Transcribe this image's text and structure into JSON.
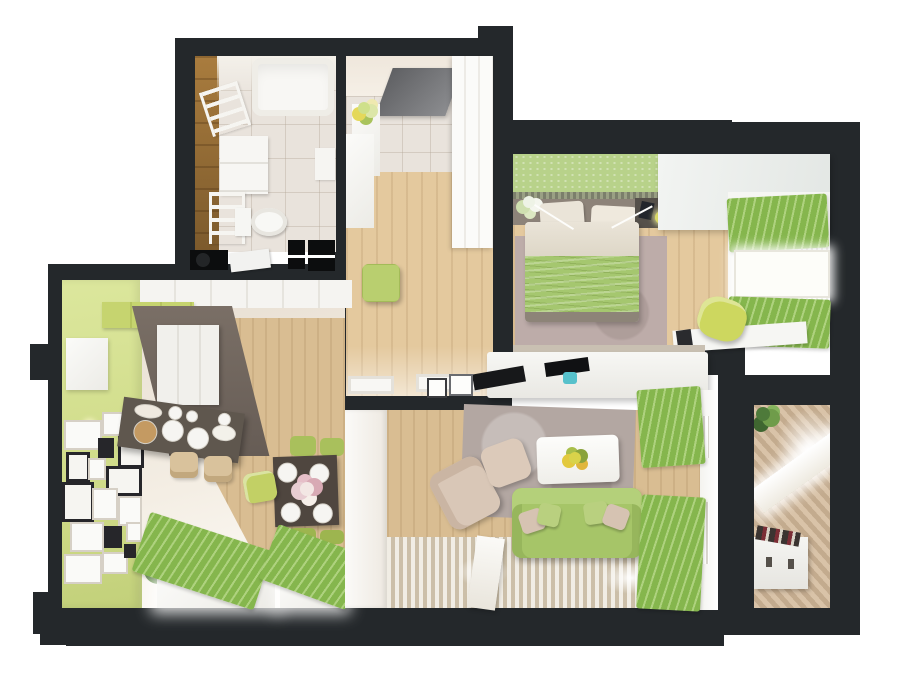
{
  "scene": {
    "type": "3d-floor-plan-render",
    "view": "top-down cutaway",
    "background": "#ffffff",
    "rooms": [
      {
        "id": "bathroom",
        "furniture": [
          "bathtub",
          "towel-ladder",
          "vanity",
          "toilet",
          "wall-cabinet",
          "wood-accent-wall"
        ]
      },
      {
        "id": "entry-hall",
        "furniture": [
          "entrance-door",
          "flower-pedestal",
          "console",
          "wardrobe",
          "green-pouf"
        ]
      },
      {
        "id": "bedroom",
        "furniture": [
          "green-headboard-wall",
          "double-bed",
          "nightstand",
          "lamp",
          "rug",
          "wardrobe",
          "window-curtains",
          "desk",
          "chair"
        ]
      },
      {
        "id": "living-kitchen",
        "furniture": [
          "green-accent-wall",
          "gallery-frames",
          "kitchen-cabinets",
          "island-counter",
          "bar-stools",
          "dining-table",
          "chairs",
          "plant",
          "window-drapes"
        ]
      },
      {
        "id": "living-room",
        "furniture": [
          "tv-console",
          "tv",
          "gray-rug",
          "coffee-table",
          "armchair",
          "ottoman",
          "green-sofa",
          "striped-rug",
          "window-curtains",
          "radiator"
        ]
      },
      {
        "id": "balcony",
        "furniture": [
          "plant",
          "window",
          "storage-bench",
          "slatted-floor"
        ]
      }
    ]
  },
  "palette": {
    "wall": "#24282b",
    "wallBlack": "#0c0d0e",
    "woodLight": "#e4c99e",
    "woodMid": "#d9bd92",
    "woodBath": "#8f6a35",
    "tile": "#e9e3dc",
    "cream": "#e9e0d4",
    "white": "#f5f4f1",
    "windowBright": "#fdfdf9",
    "greenWallPaint": "#dce79d",
    "greenCabinet": "#c6d46f",
    "greenCurtain": "#85b64d",
    "greenCurtainLight": "#aed27e",
    "greenBedWall": "#b8d28a",
    "blanket": "#a5c76f",
    "sofaGreen": "#a6c568",
    "pouf": "#b9cf6f",
    "chairGreen": "#cdd75f",
    "taupeFloor": "#6e635a",
    "islandDark": "#5f574e",
    "tableDark": "#4f463f",
    "rugGray": "#b3a7a2",
    "rugPink": "#bdaca9",
    "beige": "#d9c7b7",
    "stool": "#d9c29c",
    "balconyFloor": "#ccb49a",
    "doorGray": "#6a6b6e",
    "headboard": "#8d8379",
    "duvet": "#eae4d8",
    "teal": "#57c1cb",
    "lamp": "#e0e06a",
    "boardTan": "#c49a62",
    "plantGreen": "#6f9c4a",
    "plantDark": "#4e7a3a"
  },
  "gallery_frames": [
    {
      "x": 2,
      "y": 140,
      "w": 34,
      "h": 26,
      "kind": "w"
    },
    {
      "x": 40,
      "y": 132,
      "w": 26,
      "h": 20,
      "kind": "w"
    },
    {
      "x": 56,
      "y": 156,
      "w": 20,
      "h": 26,
      "kind": "b"
    },
    {
      "x": 36,
      "y": 158,
      "w": 16,
      "h": 20,
      "kind": "d"
    },
    {
      "x": 4,
      "y": 172,
      "w": 18,
      "h": 24,
      "kind": "b"
    },
    {
      "x": 26,
      "y": 178,
      "w": 14,
      "h": 18,
      "kind": "w"
    },
    {
      "x": 44,
      "y": 186,
      "w": 30,
      "h": 24,
      "kind": "b"
    },
    {
      "x": 0,
      "y": 202,
      "w": 26,
      "h": 34,
      "kind": "b"
    },
    {
      "x": 30,
      "y": 208,
      "w": 22,
      "h": 28,
      "kind": "w"
    },
    {
      "x": 56,
      "y": 216,
      "w": 20,
      "h": 26,
      "kind": "w"
    },
    {
      "x": 8,
      "y": 242,
      "w": 30,
      "h": 26,
      "kind": "w"
    },
    {
      "x": 42,
      "y": 246,
      "w": 18,
      "h": 22,
      "kind": "d"
    },
    {
      "x": 64,
      "y": 242,
      "w": 12,
      "h": 16,
      "kind": "w"
    },
    {
      "x": 2,
      "y": 274,
      "w": 34,
      "h": 26,
      "kind": "w"
    },
    {
      "x": 40,
      "y": 272,
      "w": 22,
      "h": 18,
      "kind": "w"
    },
    {
      "x": 62,
      "y": 264,
      "w": 12,
      "h": 14,
      "kind": "d"
    }
  ],
  "island_items": [
    {
      "name": "cutting-board",
      "x": 14,
      "y": 20,
      "d": 22,
      "color": "#c49a62"
    },
    {
      "name": "plate",
      "x": 42,
      "y": 16,
      "d": 20
    },
    {
      "name": "plate",
      "x": 68,
      "y": 20,
      "d": 20
    },
    {
      "name": "bowl",
      "x": 46,
      "y": 2,
      "d": 12
    },
    {
      "name": "bowl",
      "x": 64,
      "y": 4,
      "d": 10
    },
    {
      "name": "tray",
      "x": 12,
      "y": 4,
      "w": 26,
      "h": 12,
      "color": "#efe9df"
    },
    {
      "name": "tray",
      "x": 92,
      "y": 14,
      "w": 22,
      "h": 14,
      "color": "#f3f1ea"
    },
    {
      "name": "bowl",
      "x": 96,
      "y": 2,
      "d": 11
    }
  ],
  "dining_plates": [
    {
      "name": "plate",
      "x": 4,
      "y": 6,
      "d": 18
    },
    {
      "name": "plate",
      "x": 36,
      "y": 8,
      "d": 18
    },
    {
      "name": "plate",
      "x": 6,
      "y": 46,
      "d": 18
    },
    {
      "name": "plate",
      "x": 38,
      "y": 48,
      "d": 18
    }
  ],
  "sofa_pillows": [
    {
      "name": "pillow",
      "x": 8,
      "y": 22,
      "w": 24,
      "h": 22,
      "rot": -18,
      "color": "#d6c3b2"
    },
    {
      "name": "pillow",
      "x": 26,
      "y": 16,
      "w": 22,
      "h": 22,
      "rot": 12,
      "color": "#b9d07f"
    },
    {
      "name": "pillow",
      "x": 72,
      "y": 14,
      "w": 24,
      "h": 22,
      "rot": -8,
      "color": "#b9d07f"
    },
    {
      "name": "pillow",
      "x": 92,
      "y": 18,
      "w": 24,
      "h": 22,
      "rot": 20,
      "color": "#d6c3b2"
    }
  ]
}
